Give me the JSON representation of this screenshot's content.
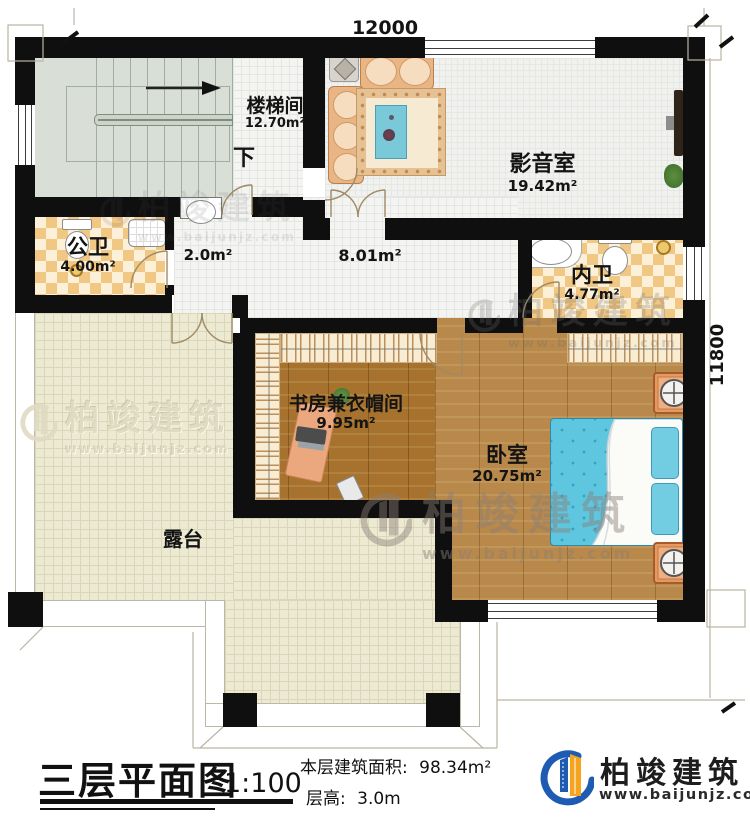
{
  "titleblock": {
    "title": "三层平面图",
    "scale": "1:100",
    "area_label": "本层建筑面积:",
    "area_value": "98.34m²",
    "height_label": "层高:",
    "height_value": "3.0m"
  },
  "brand": {
    "name": "柏竣建筑",
    "website": "www.baijunjz.com"
  },
  "watermark": {
    "name": "柏竣建筑",
    "website": "www.baijunjz.com"
  },
  "dimensions": {
    "width": "12000",
    "height": "11800"
  },
  "rooms": {
    "stairs": {
      "name": "楼梯间",
      "area": "12.70m²",
      "direction": "下"
    },
    "media": {
      "name": "影音室",
      "area": "19.42m²"
    },
    "publicBath": {
      "name": "公卫",
      "area": "4.00m²"
    },
    "lobby": {
      "area": "2.0m²"
    },
    "hall": {
      "area": "8.01m²"
    },
    "ensuite": {
      "name": "内卫",
      "area": "4.77m²"
    },
    "study": {
      "name": "书房兼衣帽间",
      "area": "9.95m²"
    },
    "bedroom": {
      "name": "卧室",
      "area": "20.75m²"
    },
    "terrace": {
      "name": "露台"
    }
  },
  "colors": {
    "wall": "#0f0f0f",
    "brand_blue": "#1e5cb3",
    "brand_orange": "#f6a41f",
    "bed_blue": "#5ec6df",
    "tile_orange": "#f1c784",
    "wood": "#a6722e",
    "terrace": "#edead3"
  }
}
